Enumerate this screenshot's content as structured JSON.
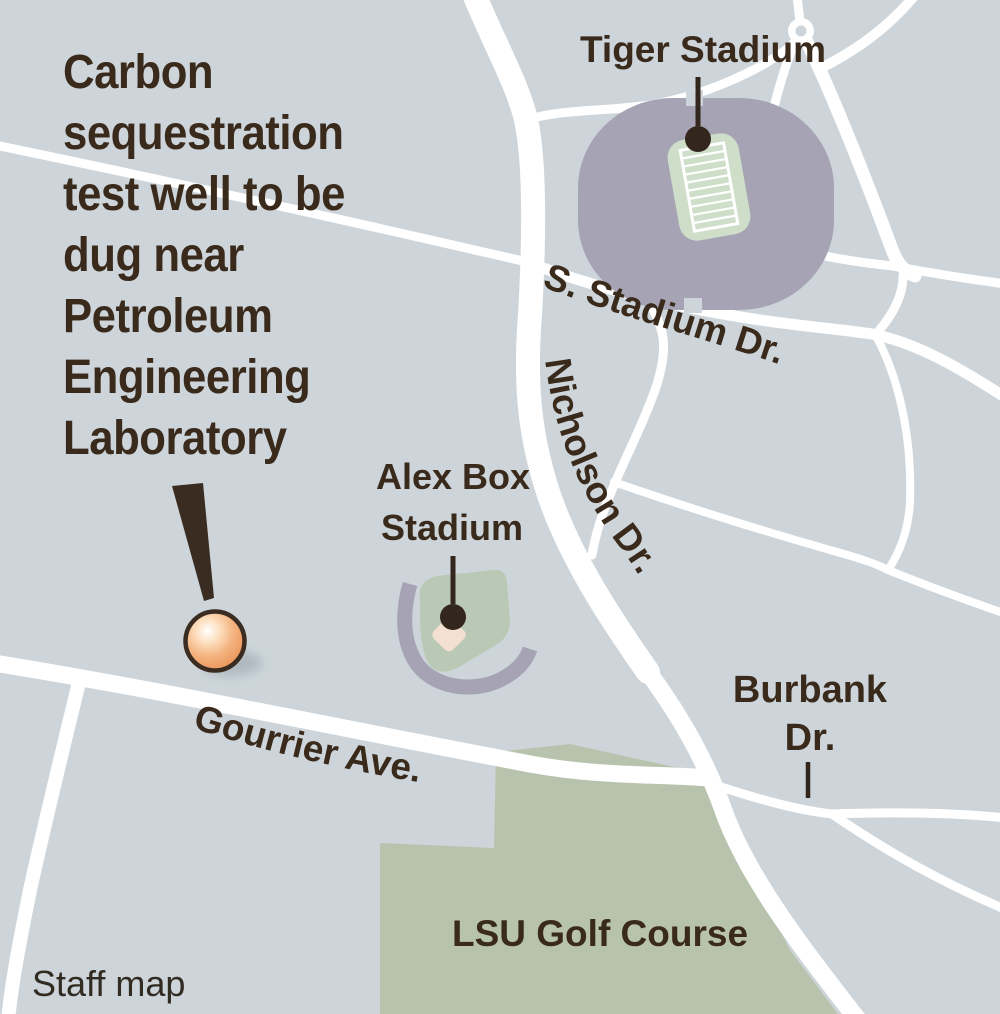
{
  "map": {
    "title": {
      "lines": [
        "Carbon",
        "sequestration",
        "test well to be",
        "dug near",
        "Petroleum",
        "Engineering",
        "Laboratory"
      ]
    },
    "labels": {
      "tiger_stadium": "Tiger Stadium",
      "alex_box_line1": "Alex Box",
      "alex_box_line2": "Stadium",
      "s_stadium_dr": "S. Stadium Dr.",
      "nicholson_dr": "Nicholson Dr.",
      "gourrier_ave": "Gourrier Ave.",
      "burbank_line1": "Burbank",
      "burbank_line2": "Dr.",
      "lsu_golf_course": "LSU Golf Course",
      "credit": "Staff map"
    },
    "colors": {
      "background": "#cdd5da",
      "road": "#ffffff",
      "golf_course": "#b8c3ad",
      "stadium_structure": "#a5a3b4",
      "tiger_field": "#cfdec9",
      "alex_box_field": "#bac9b5",
      "alex_box_infield": "#f3e0d2",
      "label_text": "#3a2a1b",
      "callout": "#33261c",
      "well_marker_outline": "#3a2c20",
      "well_marker_fill": "#ef9f63"
    }
  }
}
